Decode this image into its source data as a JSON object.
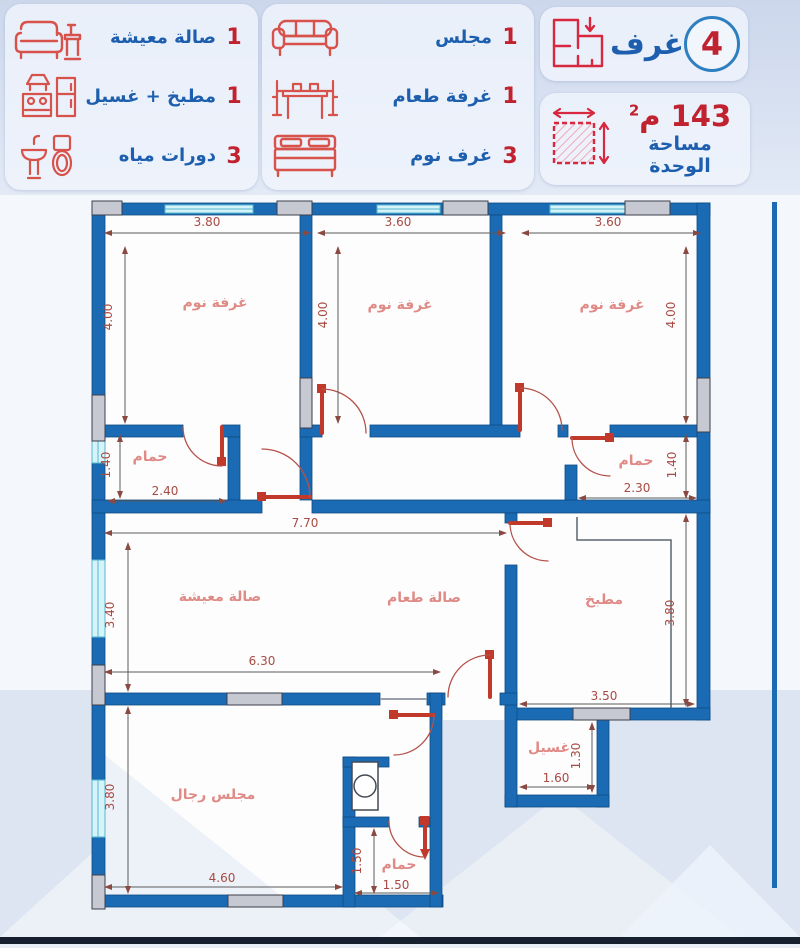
{
  "header": {
    "legend_left": [
      {
        "count": "1",
        "label": "صالة معيشة",
        "icon": "living-room-icon"
      },
      {
        "count": "1",
        "label": "مطبخ + غسيل",
        "icon": "kitchen-icon"
      },
      {
        "count": "3",
        "label": "دورات مياه",
        "icon": "bathroom-icon"
      }
    ],
    "legend_middle": [
      {
        "count": "1",
        "label": "مجلس",
        "icon": "majlis-sofa-icon"
      },
      {
        "count": "1",
        "label": "غرفة طعام",
        "icon": "dining-table-icon"
      },
      {
        "count": "3",
        "label": "غرف نوم",
        "icon": "bed-icon"
      }
    ],
    "rooms_badge": {
      "number": "4",
      "label": "غرف",
      "icon": "floor-plan-icon"
    },
    "area_badge": {
      "value": "143",
      "unit": "م",
      "sup": "2",
      "label": "مساحة الوحدة",
      "icon": "area-square-icon"
    }
  },
  "colors": {
    "wall_blue": "#1a6bb4",
    "window_cyan": "#d6f3f9",
    "column_gray": "#c6c9d2",
    "door_red": "#c0392b",
    "label_red": "#e08a86",
    "dim_red": "#a84a42",
    "header_blue": "#1d5fae",
    "header_red": "#c1222f"
  },
  "plan": {
    "rooms": [
      {
        "label": "غرفة نوم"
      },
      {
        "label": "غرفة نوم"
      },
      {
        "label": "غرفة نوم"
      },
      {
        "label": "حمام"
      },
      {
        "label": "حمام"
      },
      {
        "label": "صالة معيشة"
      },
      {
        "label": "صالة طعام"
      },
      {
        "label": "مطبخ"
      },
      {
        "label": "مجلس رجال"
      },
      {
        "label": "غسيل"
      },
      {
        "label": "حمام"
      }
    ],
    "dims": [
      {
        "value": "3.80"
      },
      {
        "value": "3.60"
      },
      {
        "value": "3.60"
      },
      {
        "value": "4.00"
      },
      {
        "value": "4.00"
      },
      {
        "value": "4.00"
      },
      {
        "value": "1.40"
      },
      {
        "value": "2.40"
      },
      {
        "value": "1.40"
      },
      {
        "value": "2.30"
      },
      {
        "value": "7.70"
      },
      {
        "value": "3.40"
      },
      {
        "value": "3.80"
      },
      {
        "value": "6.30"
      },
      {
        "value": "3.50"
      },
      {
        "value": "1.30"
      },
      {
        "value": "1.60"
      },
      {
        "value": "4.60"
      },
      {
        "value": "3.80"
      },
      {
        "value": "1.50"
      },
      {
        "value": "1.50"
      }
    ]
  }
}
